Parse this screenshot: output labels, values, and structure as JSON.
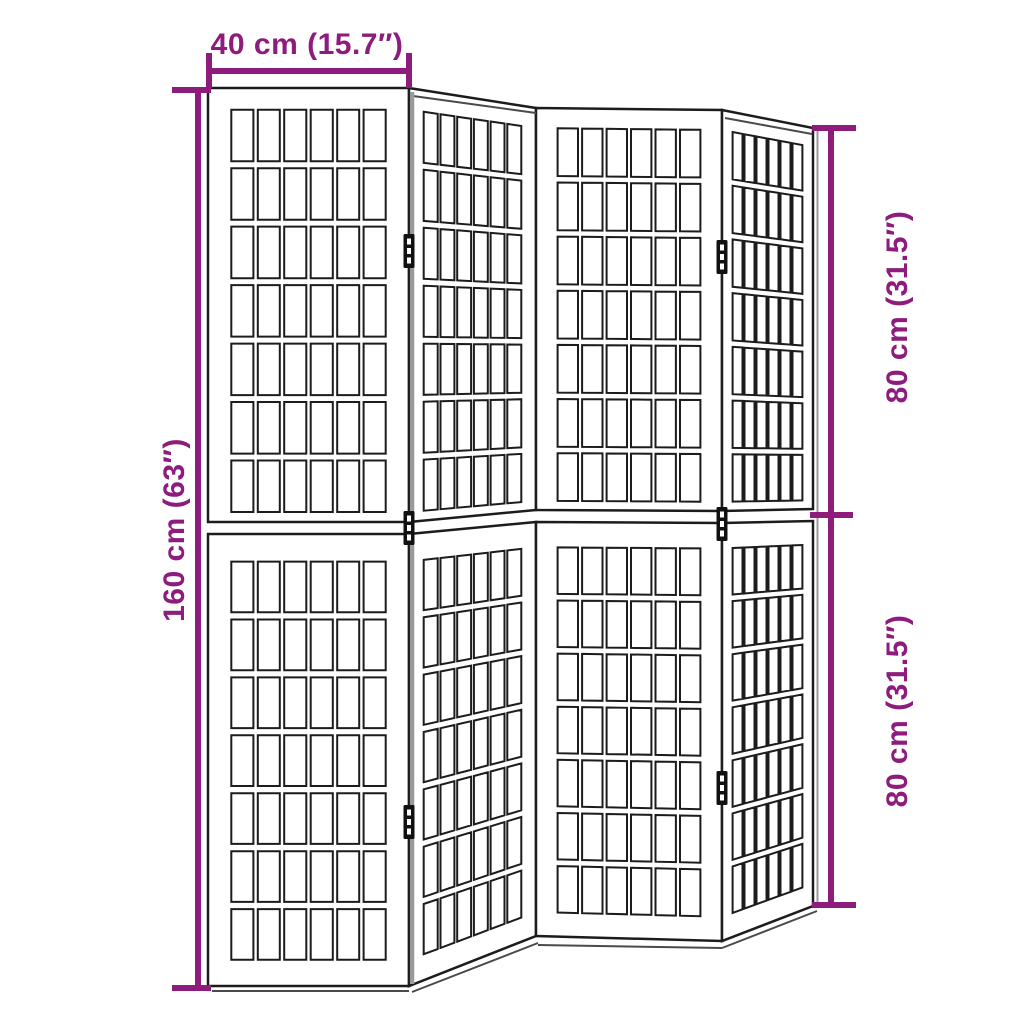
{
  "meta": {
    "type": "product-dimension-diagram",
    "subject": "folding room divider with shoji-style lattice panels"
  },
  "colors": {
    "dimension_accent": "#8d1c7d",
    "outline": "#1c1c1c",
    "edge_gray": "#9a9a9a",
    "thickness_line": "#4a4a4a",
    "background": "#ffffff"
  },
  "dimensions": {
    "width": {
      "label": "40 cm (15.7″)"
    },
    "height_total": {
      "label": "160 cm (63″)"
    },
    "height_top_half": {
      "label": "80 cm (31.5″)"
    },
    "height_bottom_half": {
      "label": "80 cm (31.5″)"
    }
  },
  "divider": {
    "panel_count": 4,
    "halves_per_panel": 2,
    "grid_columns": 6,
    "grid_rows_per_half": 7,
    "hinges_per_junction": 3
  }
}
